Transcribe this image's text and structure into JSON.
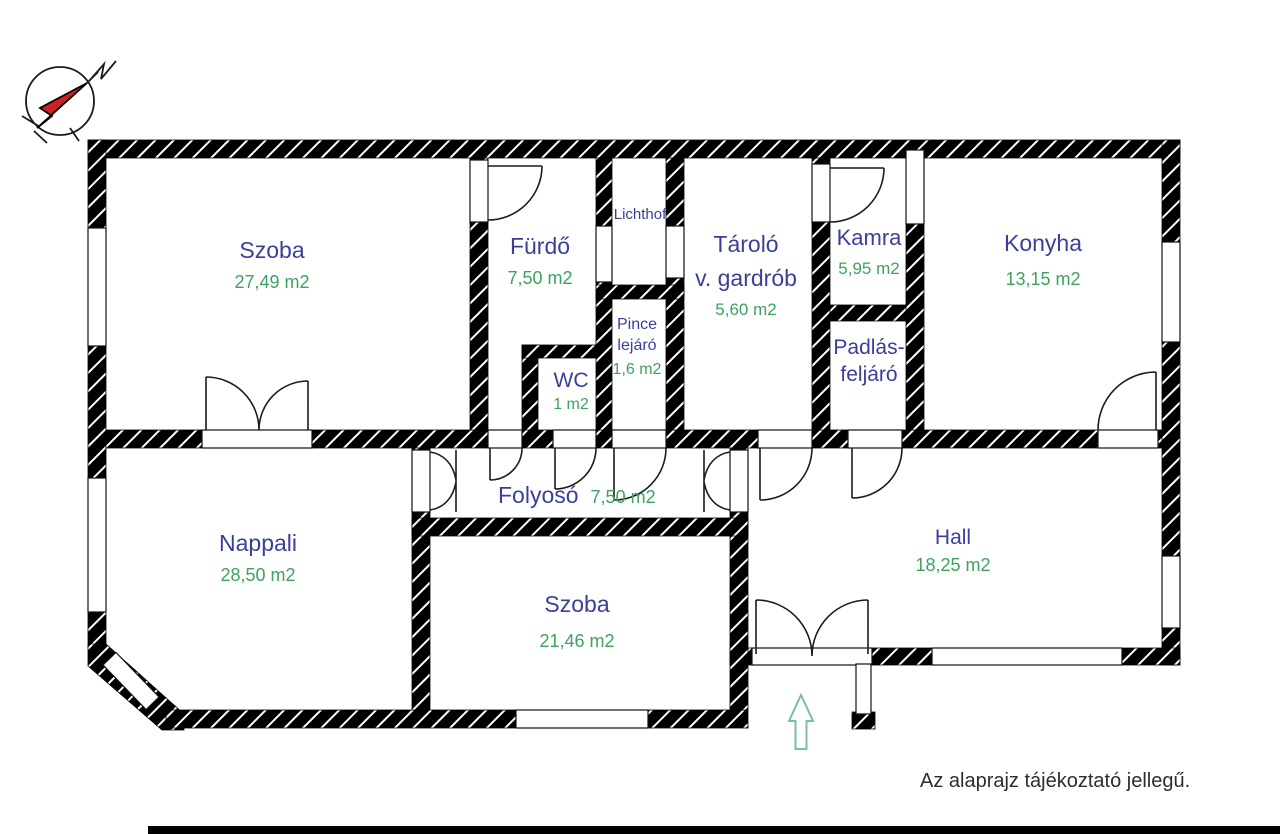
{
  "note": "Az alaprajz tájékoztató jellegű.",
  "colors": {
    "room_name": "#3a3f99",
    "room_area": "#3da35f",
    "wall": "#000000",
    "entrance_arrow": "#7bbf9b",
    "note_text": "#2d2d2d",
    "compass_red": "#cc2222"
  },
  "rooms": [
    {
      "key": "szoba-1",
      "name": "Szoba",
      "area": "27,49 m2"
    },
    {
      "key": "furdo",
      "name": "Fürdő",
      "area": "7,50 m2"
    },
    {
      "key": "lichthof",
      "name": "Lichthof"
    },
    {
      "key": "pince-lejaro",
      "name_line1": "Pince",
      "name_line2": "lejáró",
      "area": "1,6 m2"
    },
    {
      "key": "wc",
      "name": "WC",
      "area": "1 m2"
    },
    {
      "key": "tarolo",
      "name_line1": "Tároló",
      "name_line2": "v. gardrób",
      "area": "5,60 m2"
    },
    {
      "key": "kamra",
      "name": "Kamra",
      "area": "5,95 m2"
    },
    {
      "key": "padlas-feljaro",
      "name_line1": "Padlás-",
      "name_line2": "feljáró"
    },
    {
      "key": "konyha",
      "name": "Konyha",
      "area": "13,15 m2"
    },
    {
      "key": "folyoso",
      "name": "Folyosó",
      "area": "7,50 m2"
    },
    {
      "key": "nappali",
      "name": "Nappali",
      "area": "28,50 m2"
    },
    {
      "key": "szoba-2",
      "name": "Szoba",
      "area": "21,46 m2"
    },
    {
      "key": "hall",
      "name": "Hall",
      "area": "18,25 m2"
    }
  ]
}
